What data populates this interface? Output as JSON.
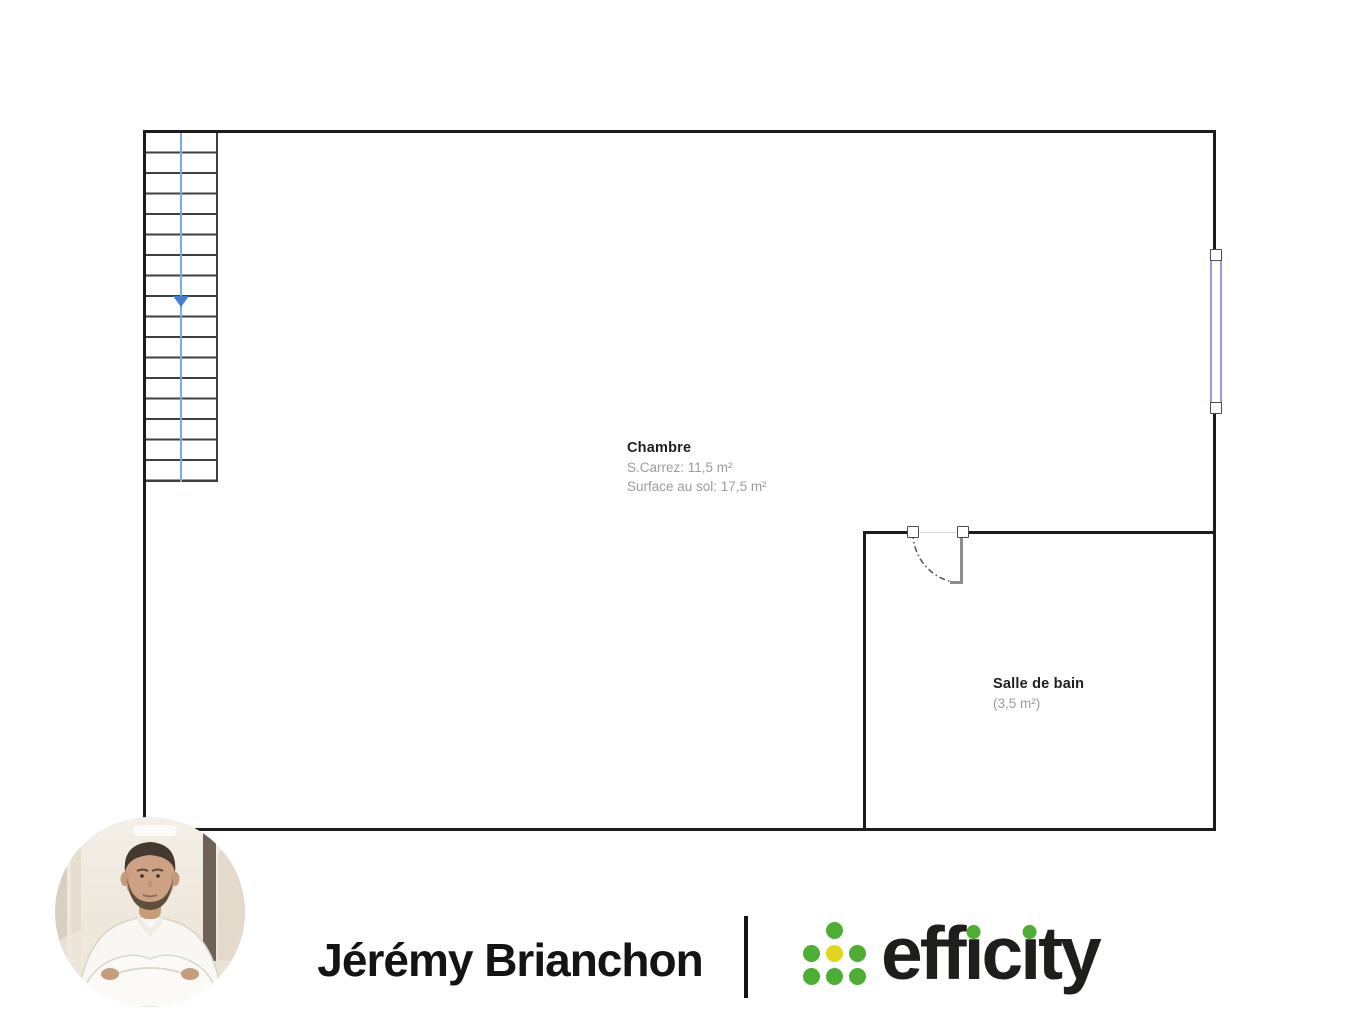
{
  "theme": {
    "wall": "#1c1c1c",
    "stair_line": "#3f3f3f",
    "stair_guide": "#7babde",
    "stair_arrow": "#3f7ed0",
    "window": "#9b9ad7",
    "room_label": "#1f1f1f",
    "room_sublabel": "#9c9c9c",
    "brand_green": "#4cae32",
    "brand_yellow": "#e2d51d",
    "brand_text": "#1e1e1c",
    "name_text": "#141414"
  },
  "floorplan": {
    "chambre": {
      "title": "Chambre",
      "line1": "S.Carrez: 11,5 m²",
      "line2": "Surface au sol: 17,5 m²"
    },
    "salle_de_bain": {
      "title": "Salle de bain",
      "area": "(3,5 m²)"
    }
  },
  "footer": {
    "agent_name": "Jérémy Brianchon",
    "brand": {
      "full_name": "efficity",
      "parts": {
        "p1": "eff",
        "dotless_i": "ı",
        "p2": "c",
        "p3": "ty"
      }
    }
  }
}
